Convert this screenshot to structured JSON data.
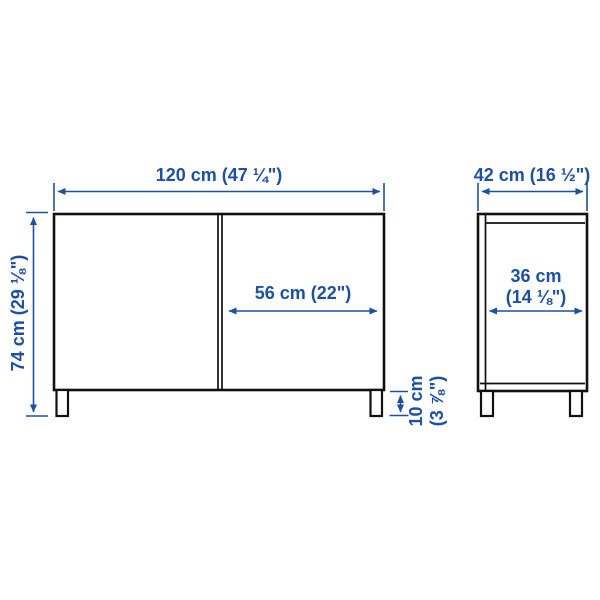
{
  "colors": {
    "accent": "#1d4fa5",
    "line": "#111111",
    "bg": "#ffffff"
  },
  "diagram": {
    "kind": "furniture-dimension-drawing",
    "views": [
      {
        "name": "front-view"
      },
      {
        "name": "side-view"
      }
    ],
    "dims": {
      "front_width": {
        "label": "120 cm (47 ¼\")"
      },
      "front_height": {
        "label": "74 cm (29 ⅛\")"
      },
      "door_width": {
        "label": "56 cm (22\")"
      },
      "leg_height": {
        "label": "10 cm\n(3 ⅞\")"
      },
      "side_depth": {
        "label": "42 cm (16 ½\")"
      },
      "side_inner_depth": {
        "label": "36 cm\n(14 ⅛\")"
      }
    }
  }
}
